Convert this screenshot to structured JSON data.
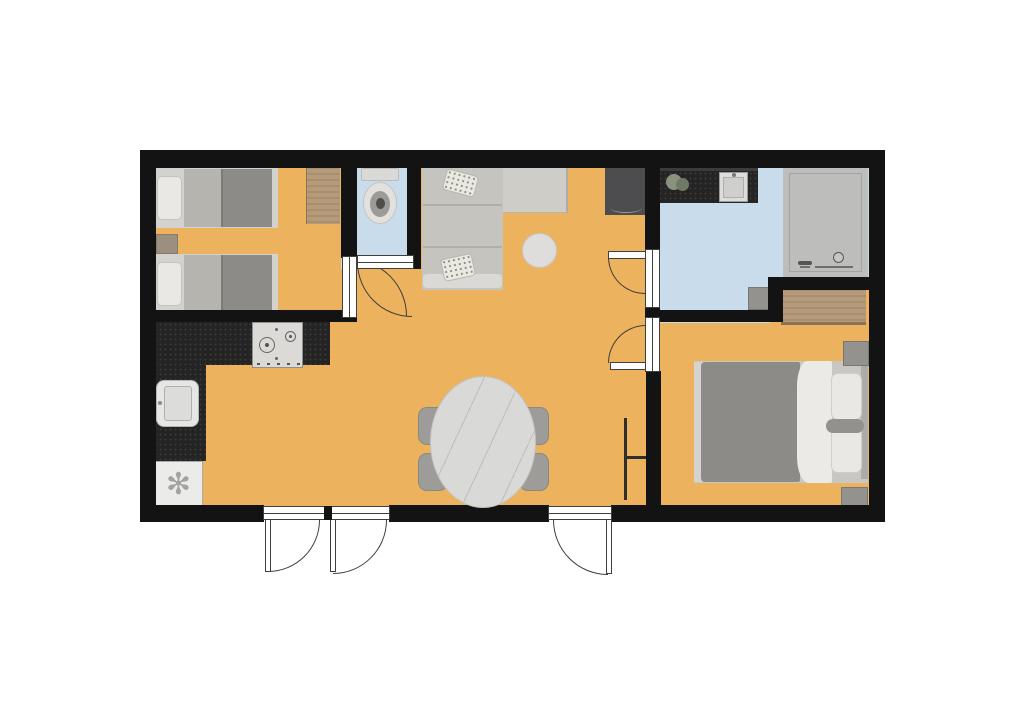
{
  "scene": "apartment-floor-plan",
  "palette": {
    "wall": "#131313",
    "floor-main": "#ecb25e",
    "floor-wet": "#c9dcec",
    "shower": "#bdbdbb",
    "counter": "#242424",
    "wood": "#b59b79",
    "sofa": "#c6c4bf",
    "sofa-light": "#cfcdc8",
    "sofa-arm": "#dad9d5",
    "blanket": "#8d8b87",
    "bed-mid": "#b6b4af",
    "white-fixture": "#e9e8e5",
    "gray-furniture": "#94928e",
    "tv": "#4d4d4f",
    "marble": "#d9d9d7",
    "chair": "#9e9c98",
    "line": "#3f3f3f"
  },
  "rooms": [
    {
      "name": "twin-bedroom",
      "floor": "main",
      "furniture": [
        "single-bed",
        "single-bed",
        "nightstand",
        "wardrobe"
      ]
    },
    {
      "name": "wc",
      "floor": "wet",
      "furniture": [
        "toilet"
      ]
    },
    {
      "name": "living-dining-room",
      "floor": "main",
      "furniture": [
        "corner-sofa",
        "throw-pillow",
        "throw-pillow",
        "coffee-table",
        "tv-cabinet",
        "dining-table",
        "dining-chair",
        "dining-chair",
        "dining-chair",
        "dining-chair",
        "radiator"
      ]
    },
    {
      "name": "kitchen",
      "floor": "main",
      "furniture": [
        "l-shaped-counter",
        "gas-hob",
        "kitchen-sink",
        "refrigerator"
      ]
    },
    {
      "name": "bathroom",
      "floor": "wet",
      "furniture": [
        "vanity-counter",
        "washbasin",
        "plant",
        "shower",
        "cabinet"
      ]
    },
    {
      "name": "master-bedroom",
      "floor": "main",
      "furniture": [
        "double-bed",
        "pillow",
        "pillow",
        "bolster-pillow",
        "nightstand",
        "nightstand",
        "dresser"
      ]
    }
  ],
  "doors": [
    {
      "name": "entry-double-door",
      "type": "double-swing",
      "wall": "south"
    },
    {
      "name": "entry-single-door",
      "type": "single-swing",
      "wall": "south"
    },
    {
      "name": "twin-bedroom-door",
      "type": "single-swing"
    },
    {
      "name": "wc-door",
      "type": "single-swing"
    },
    {
      "name": "bathroom-door",
      "type": "single-swing"
    },
    {
      "name": "master-bedroom-door",
      "type": "single-swing"
    }
  ],
  "refrigerator_symbol": "✻"
}
